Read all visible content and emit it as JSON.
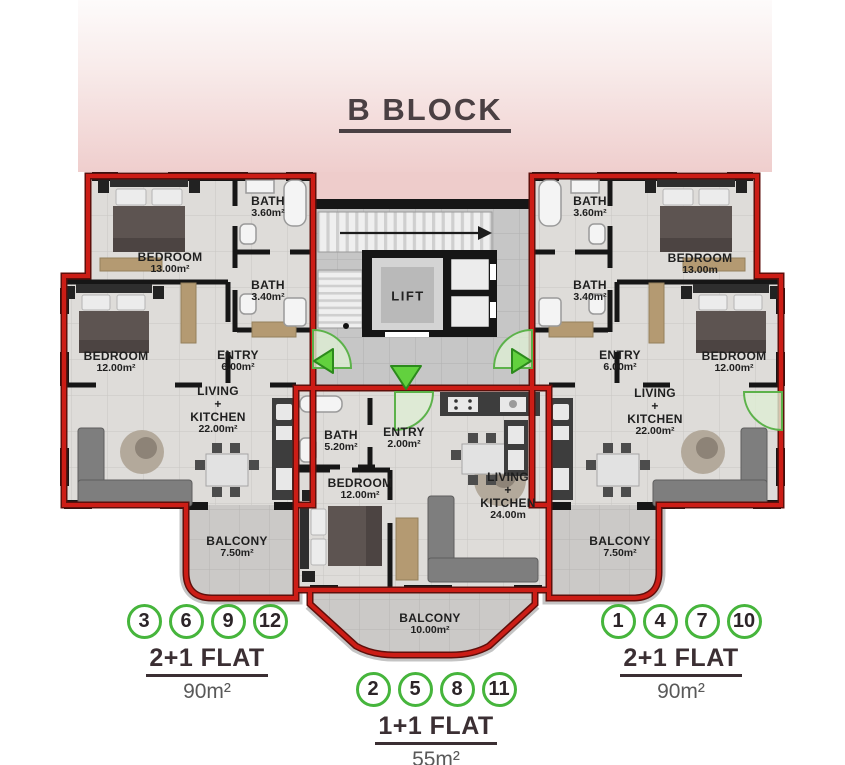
{
  "title": "B BLOCK",
  "lift_label": "LIFT",
  "rooms": {
    "l_bed13": {
      "name": "BEDROOM",
      "area": "13.00m²"
    },
    "l_bath36": {
      "name": "BATH",
      "area": "3.60m²"
    },
    "l_bath34": {
      "name": "BATH",
      "area": "3.40m²"
    },
    "l_bed12": {
      "name": "BEDROOM",
      "area": "12.00m²"
    },
    "l_entry": {
      "name": "ENTRY",
      "area": "6.00m²"
    },
    "l_living": {
      "name": "LIVING\n+\nKITCHEN",
      "area": "22.00m²"
    },
    "l_balcony": {
      "name": "BALCONY",
      "area": "7.50m²"
    },
    "c_bath": {
      "name": "BATH",
      "area": "5.20m²"
    },
    "c_entry": {
      "name": "ENTRY",
      "area": "2.00m²"
    },
    "c_bed": {
      "name": "BEDROOM",
      "area": "12.00m²"
    },
    "c_living": {
      "name": "LIVING\n+\nKITCHEN",
      "area": "24.00m"
    },
    "c_balcony": {
      "name": "BALCONY",
      "area": "10.00m²"
    },
    "r_bath36": {
      "name": "BATH",
      "area": "3.60m²"
    },
    "r_bed13": {
      "name": "BEDROOM",
      "area": "13.00m"
    },
    "r_bath34": {
      "name": "BATH",
      "area": "3.40m²"
    },
    "r_entry": {
      "name": "ENTRY",
      "area": "6.00m²"
    },
    "r_bed12": {
      "name": "BEDROOM",
      "area": "12.00m²"
    },
    "r_living": {
      "name": "LIVING\n+\nKITCHEN",
      "area": "22.00m²"
    },
    "r_balcony": {
      "name": "BALCONY",
      "area": "7.50m²"
    }
  },
  "legend": {
    "left": {
      "units": [
        "3",
        "6",
        "9",
        "12"
      ],
      "type": "2+1 FLAT",
      "size": "90m²"
    },
    "center": {
      "units": [
        "2",
        "5",
        "8",
        "11"
      ],
      "type": "1+1 FLAT",
      "size": "55m²"
    },
    "right": {
      "units": [
        "1",
        "4",
        "7",
        "10"
      ],
      "type": "2+1 FLAT",
      "size": "90m²"
    }
  },
  "colors": {
    "wall_red": "#c6201a",
    "wall_black": "#161616",
    "unit_green": "#46b53c",
    "header_pink": "#efcecd",
    "floor_gray": "#dedcd9"
  }
}
